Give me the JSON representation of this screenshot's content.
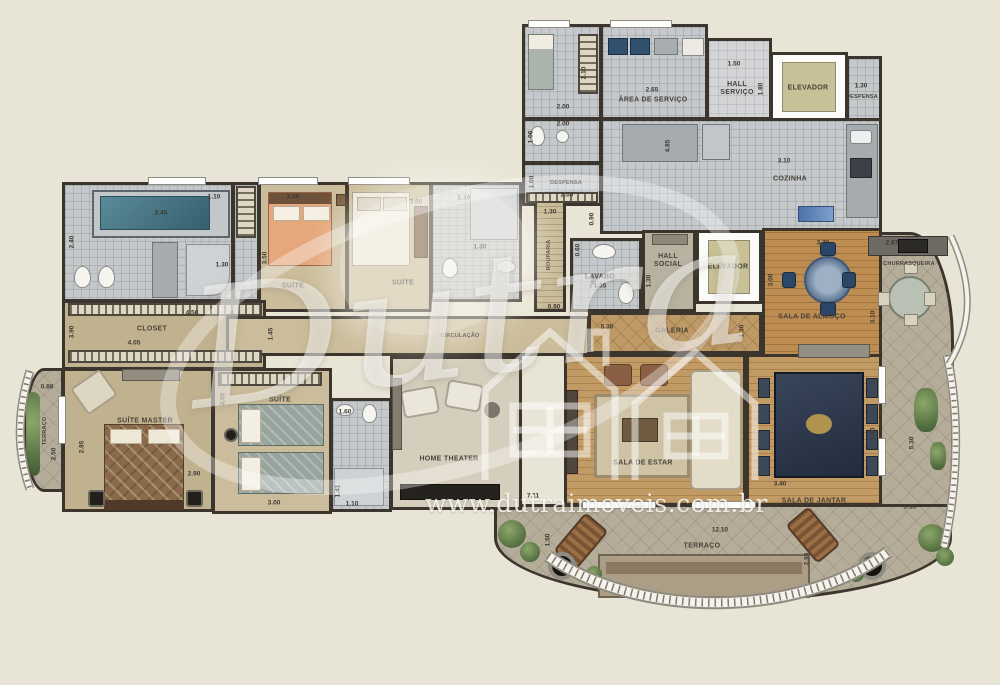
{
  "watermark": {
    "brand": "Dutra",
    "url": "www.dutraimoveis.com.br",
    "logo_icon": "house-outline-icon"
  },
  "labels": {
    "area_servico": "ÁREA DE SERVIÇO",
    "hall_servico": "HALL SERVIÇO",
    "elevador": "ELEVADOR",
    "despensa": "DESPENSA",
    "cozinha": "COZINHA",
    "rouparia": "ROUPARIA",
    "lavabo": "LAVABO",
    "hall_social": "HALL SOCIAL",
    "galeria": "GALERIA",
    "sala_almoco": "SALA DE ALMOÇO",
    "churrasqueira": "CHURRASQUEIRA",
    "suite": "SUÍTE",
    "suite_master": "SUÍTE MASTER",
    "closet": "CLOSET",
    "terraco": "TERRAÇO",
    "circulacao": "CIRCULAÇÃO",
    "home_theater": "HOME THEATER",
    "sala_estar": "SALA DE ESTAR",
    "sala_jantar": "SALA DE JANTAR"
  },
  "dims": {
    "maid_h": "2.10",
    "maid_w": "2.00",
    "wc_w": "2.00",
    "wc_h": "1.06",
    "despl_h": "1.00",
    "despl_w": "2.00",
    "aserv_w": "2.65",
    "hallserv_w": "1.50",
    "hallserv_h": "1.80",
    "desptr_w": "1.30",
    "coz_w": "3.10",
    "coz_h": "4.85",
    "coz_gap": "0.90",
    "roup_w": "1.30",
    "roup_l": "0.90",
    "lav_niche": "0.60",
    "lav_v": "1.35",
    "hallsoc_h": "1.30",
    "gal_w": "5.30",
    "gal_h": "1.30",
    "alm_w": "3.70",
    "alm_h": "3.00",
    "churr_h": "3.10",
    "churr_w": "2.67",
    "mbath_tub": "2.45",
    "mbath_h": "2.40",
    "mbath_d": "1.30",
    "mini_w": "1.10",
    "s1_w": "3.00",
    "s1_h": "3.50",
    "s2_w": "3.00",
    "s2b_w": "1.10",
    "s2b_d": "1.30",
    "clo_w1": "4.50",
    "clo_w2": "4.05",
    "clo_h": "3.90",
    "circ_h": "1.45",
    "mas_h": "2.85",
    "mas_w": "2.90",
    "terl_w": "0.88",
    "terl_h": "2.50",
    "tw_h": "3.05",
    "tw_w": "3.00",
    "tb_w": "1.60",
    "tb_h": "1.41",
    "tb_w2": "1.10",
    "est_w": "7.11",
    "jan_w": "3.40",
    "jan_gap": "1.40",
    "terr_h": "5.30",
    "terr_w": "1.13",
    "terrb_w": "12.10",
    "terrb_h": "1.50",
    "terrb_h2": "2.93"
  }
}
